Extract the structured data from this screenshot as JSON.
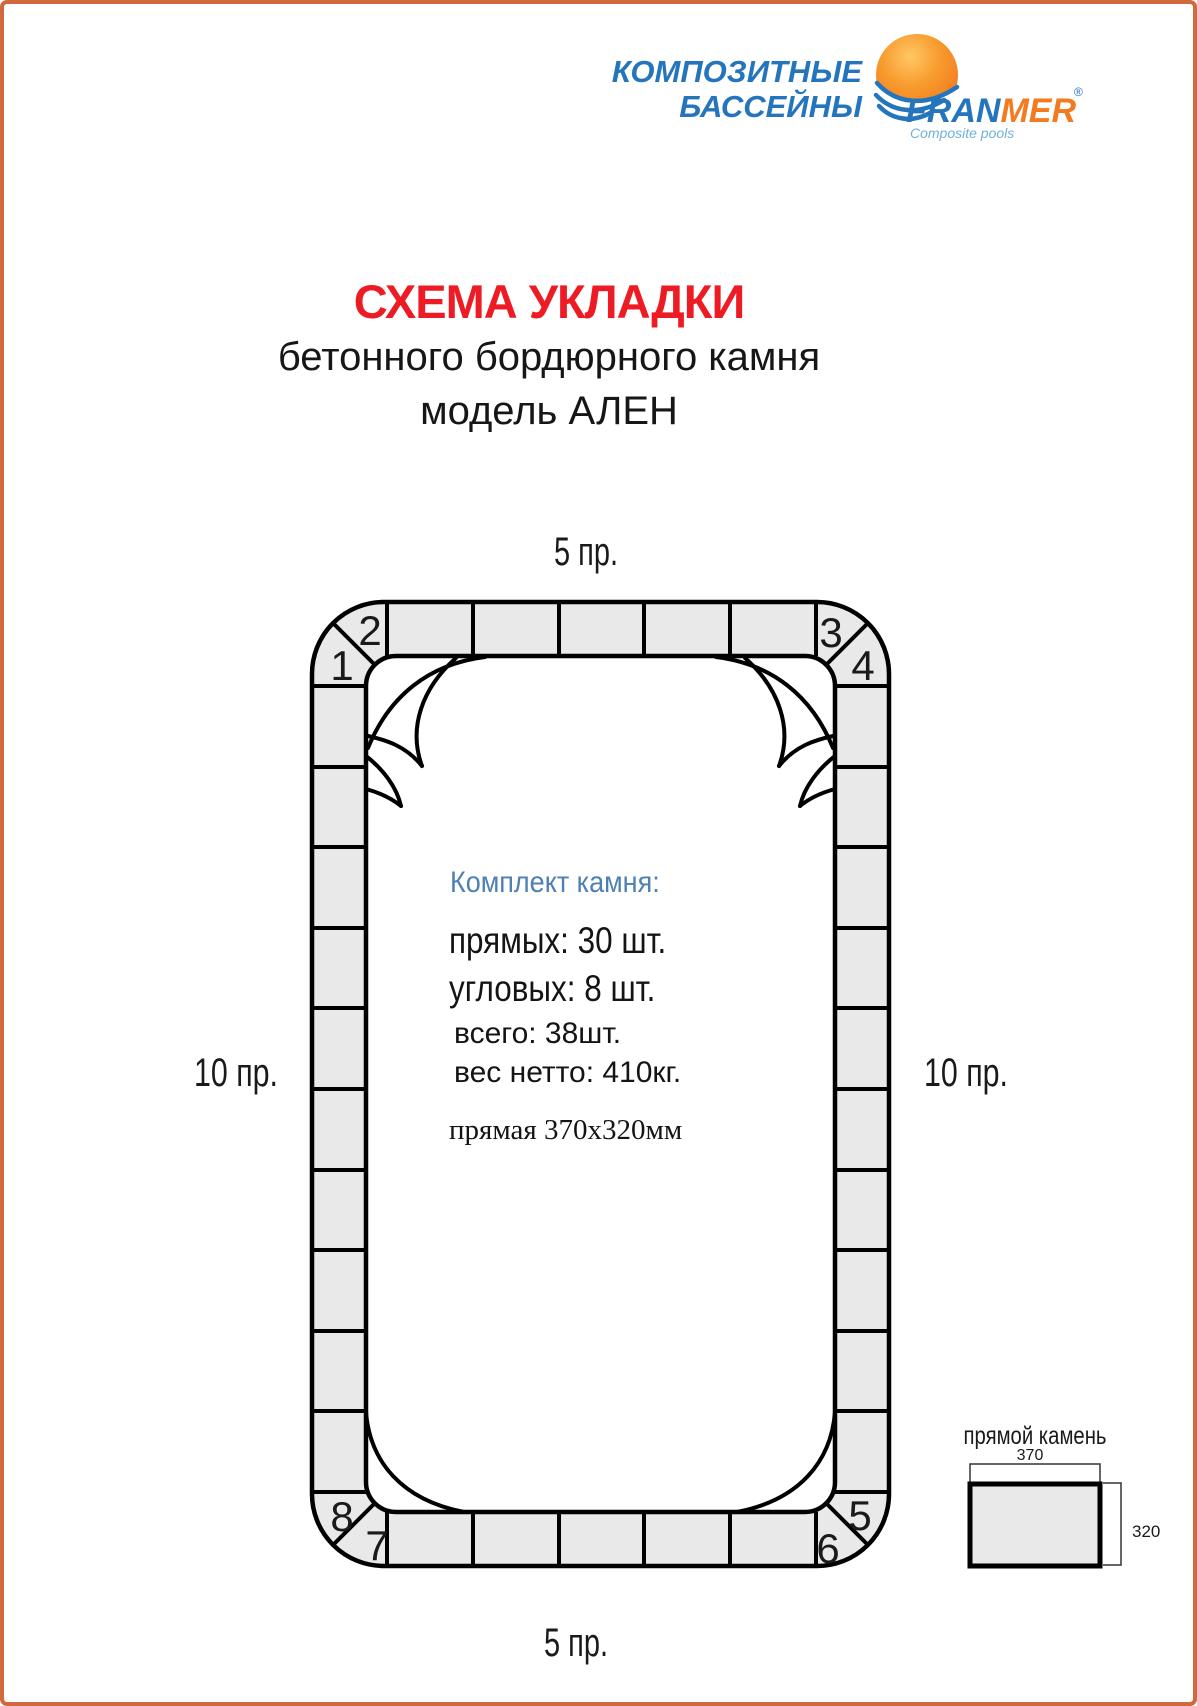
{
  "header": {
    "brand_line1": "КОМПОЗИТНЫЕ",
    "brand_line2": "БАССЕЙНЫ",
    "logo_fran": "FRAN",
    "logo_mer": "MER",
    "registered_mark": "®",
    "tagline": "Composite pools"
  },
  "title": {
    "line1": "СХЕМА УКЛАДКИ",
    "line2": "бетонного бордюрного камня",
    "line3": "модель АЛЕН"
  },
  "diagram": {
    "side_labels": {
      "top": "5 пр.",
      "bottom": "5 пр.",
      "left": "10 пр.",
      "right": "10 пр."
    },
    "corner_numbers": [
      "1",
      "2",
      "3",
      "4",
      "5",
      "6",
      "7",
      "8"
    ],
    "counts": {
      "heading": "Комплект камня:",
      "straight": "прямых: 30 шт.",
      "corner": "угловых: 8 шт.",
      "total": "всего: 38шт.",
      "net_weight": "вес нетто: 410кг.",
      "stone_size": "прямая 370х320мм"
    },
    "stone_detail": {
      "title": "прямой камень",
      "width": "370",
      "height": "320"
    }
  },
  "colors": {
    "page_border": "#d2693c",
    "brand_blue": "#2575bc",
    "brand_orange": "#f47a20",
    "tagline_blue": "#70b0dd",
    "title_red": "#ed1c24",
    "info_heading_blue": "#4e80b4",
    "stone_fill": "#e9e9e9",
    "line_black": "#000000"
  }
}
